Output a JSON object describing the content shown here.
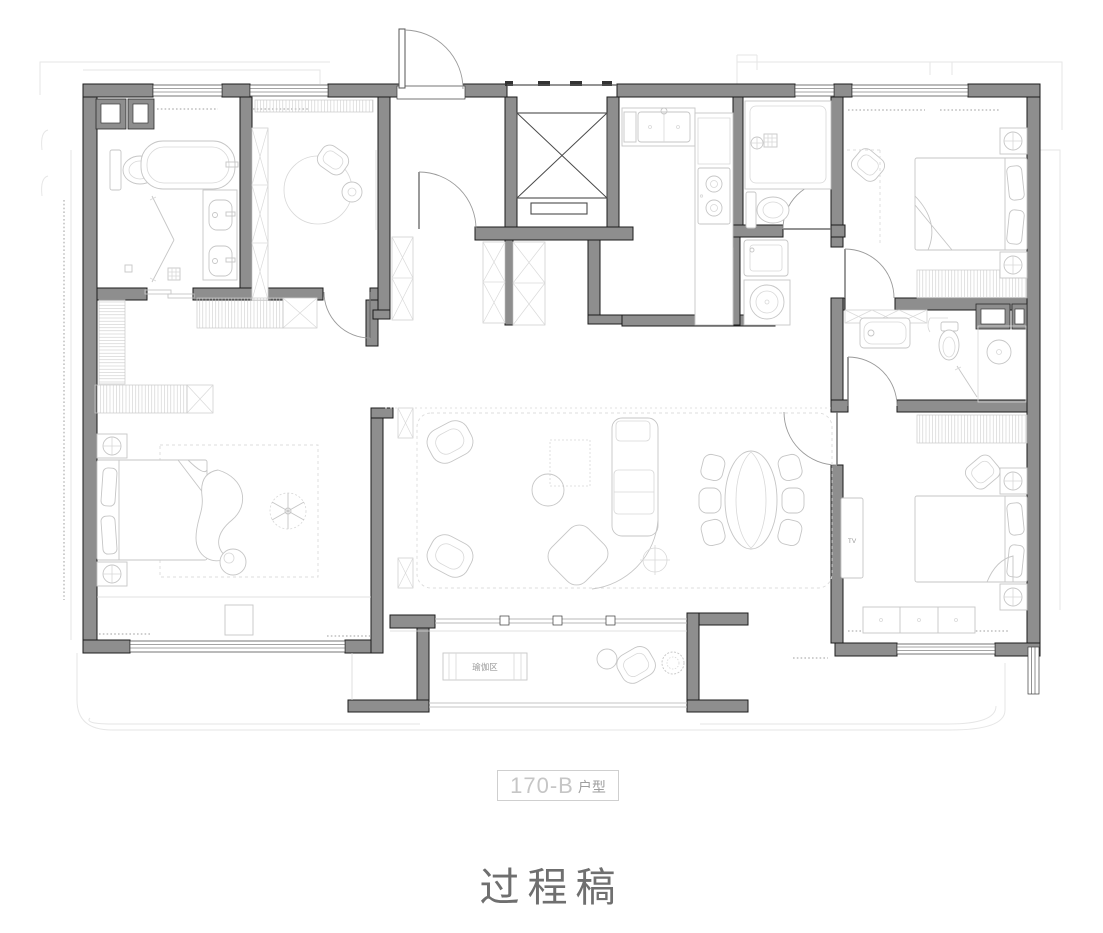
{
  "footer": {
    "unit_number": "170-B",
    "unit_suffix": "户型",
    "draft_label": "过程稿"
  },
  "plan_labels": {
    "yoga_area": "瑜伽区",
    "tv": "TV"
  },
  "colors": {
    "wall_fill": "#8e8e8e",
    "wall_outline": "#1c1c1c",
    "window_line": "#3a3a3a",
    "furniture_line": "#c6c6c6",
    "cabinet_line": "#d0d0d0",
    "faint_line": "#e6e6e6",
    "door_arc": "#9a9a9a",
    "yoga_label_color": "#9a9a9a",
    "tv_label_color": "#b8b8b8",
    "unit_label_color": "#c6c6c6",
    "draft_label_color": "#6f6f6f"
  }
}
